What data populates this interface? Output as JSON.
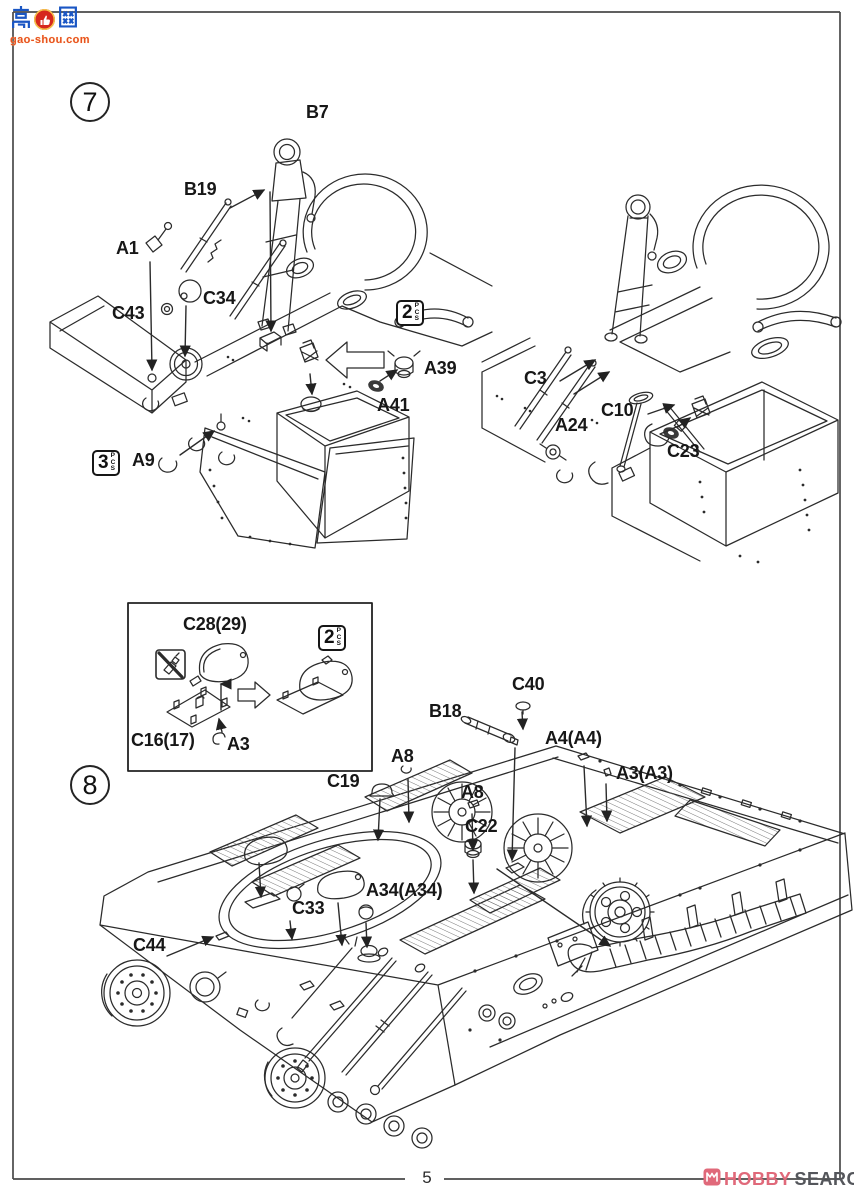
{
  "watermark": {
    "cn_text": "高网",
    "thumb_icon": "thumb-up-icon",
    "domain": "gao-shou.com"
  },
  "steps": {
    "step7": "7",
    "step8": "8"
  },
  "footer": {
    "page_number": "5",
    "logo_hobby": "HOBBY",
    "logo_search": "SEARCH"
  },
  "pcs_badges": [
    {
      "count": "2",
      "unit": "PCS",
      "x": 396,
      "y": 300
    },
    {
      "count": "3",
      "unit": "PCS",
      "x": 92,
      "y": 450
    },
    {
      "count": "2",
      "unit": "PCS",
      "x": 318,
      "y": 625
    }
  ],
  "part_labels": [
    {
      "text": "B7",
      "x": 306,
      "y": 103
    },
    {
      "text": "B19",
      "x": 184,
      "y": 180
    },
    {
      "text": "A1",
      "x": 116,
      "y": 239
    },
    {
      "text": "C43",
      "x": 112,
      "y": 304
    },
    {
      "text": "C34",
      "x": 203,
      "y": 289
    },
    {
      "text": "A39",
      "x": 424,
      "y": 359
    },
    {
      "text": "A41",
      "x": 377,
      "y": 396
    },
    {
      "text": "A9",
      "x": 132,
      "y": 451
    },
    {
      "text": "C3",
      "x": 524,
      "y": 369
    },
    {
      "text": "A24",
      "x": 555,
      "y": 416
    },
    {
      "text": "C10",
      "x": 601,
      "y": 401
    },
    {
      "text": "C23",
      "x": 667,
      "y": 442
    },
    {
      "text": "C28(29)",
      "x": 183,
      "y": 615
    },
    {
      "text": "C16(17)",
      "x": 131,
      "y": 731
    },
    {
      "text": "A3",
      "x": 227,
      "y": 735
    },
    {
      "text": "C40",
      "x": 512,
      "y": 675
    },
    {
      "text": "B18",
      "x": 429,
      "y": 702
    },
    {
      "text": "A4(A4)",
      "x": 545,
      "y": 729
    },
    {
      "text": "A3(A3)",
      "x": 616,
      "y": 764
    },
    {
      "text": "A8",
      "x": 391,
      "y": 747
    },
    {
      "text": "C19",
      "x": 327,
      "y": 772
    },
    {
      "text": "A8",
      "x": 461,
      "y": 783
    },
    {
      "text": "C22",
      "x": 465,
      "y": 817
    },
    {
      "text": "A34(A34)",
      "x": 366,
      "y": 881
    },
    {
      "text": "C33",
      "x": 292,
      "y": 899
    },
    {
      "text": "C44",
      "x": 133,
      "y": 936
    }
  ]
}
